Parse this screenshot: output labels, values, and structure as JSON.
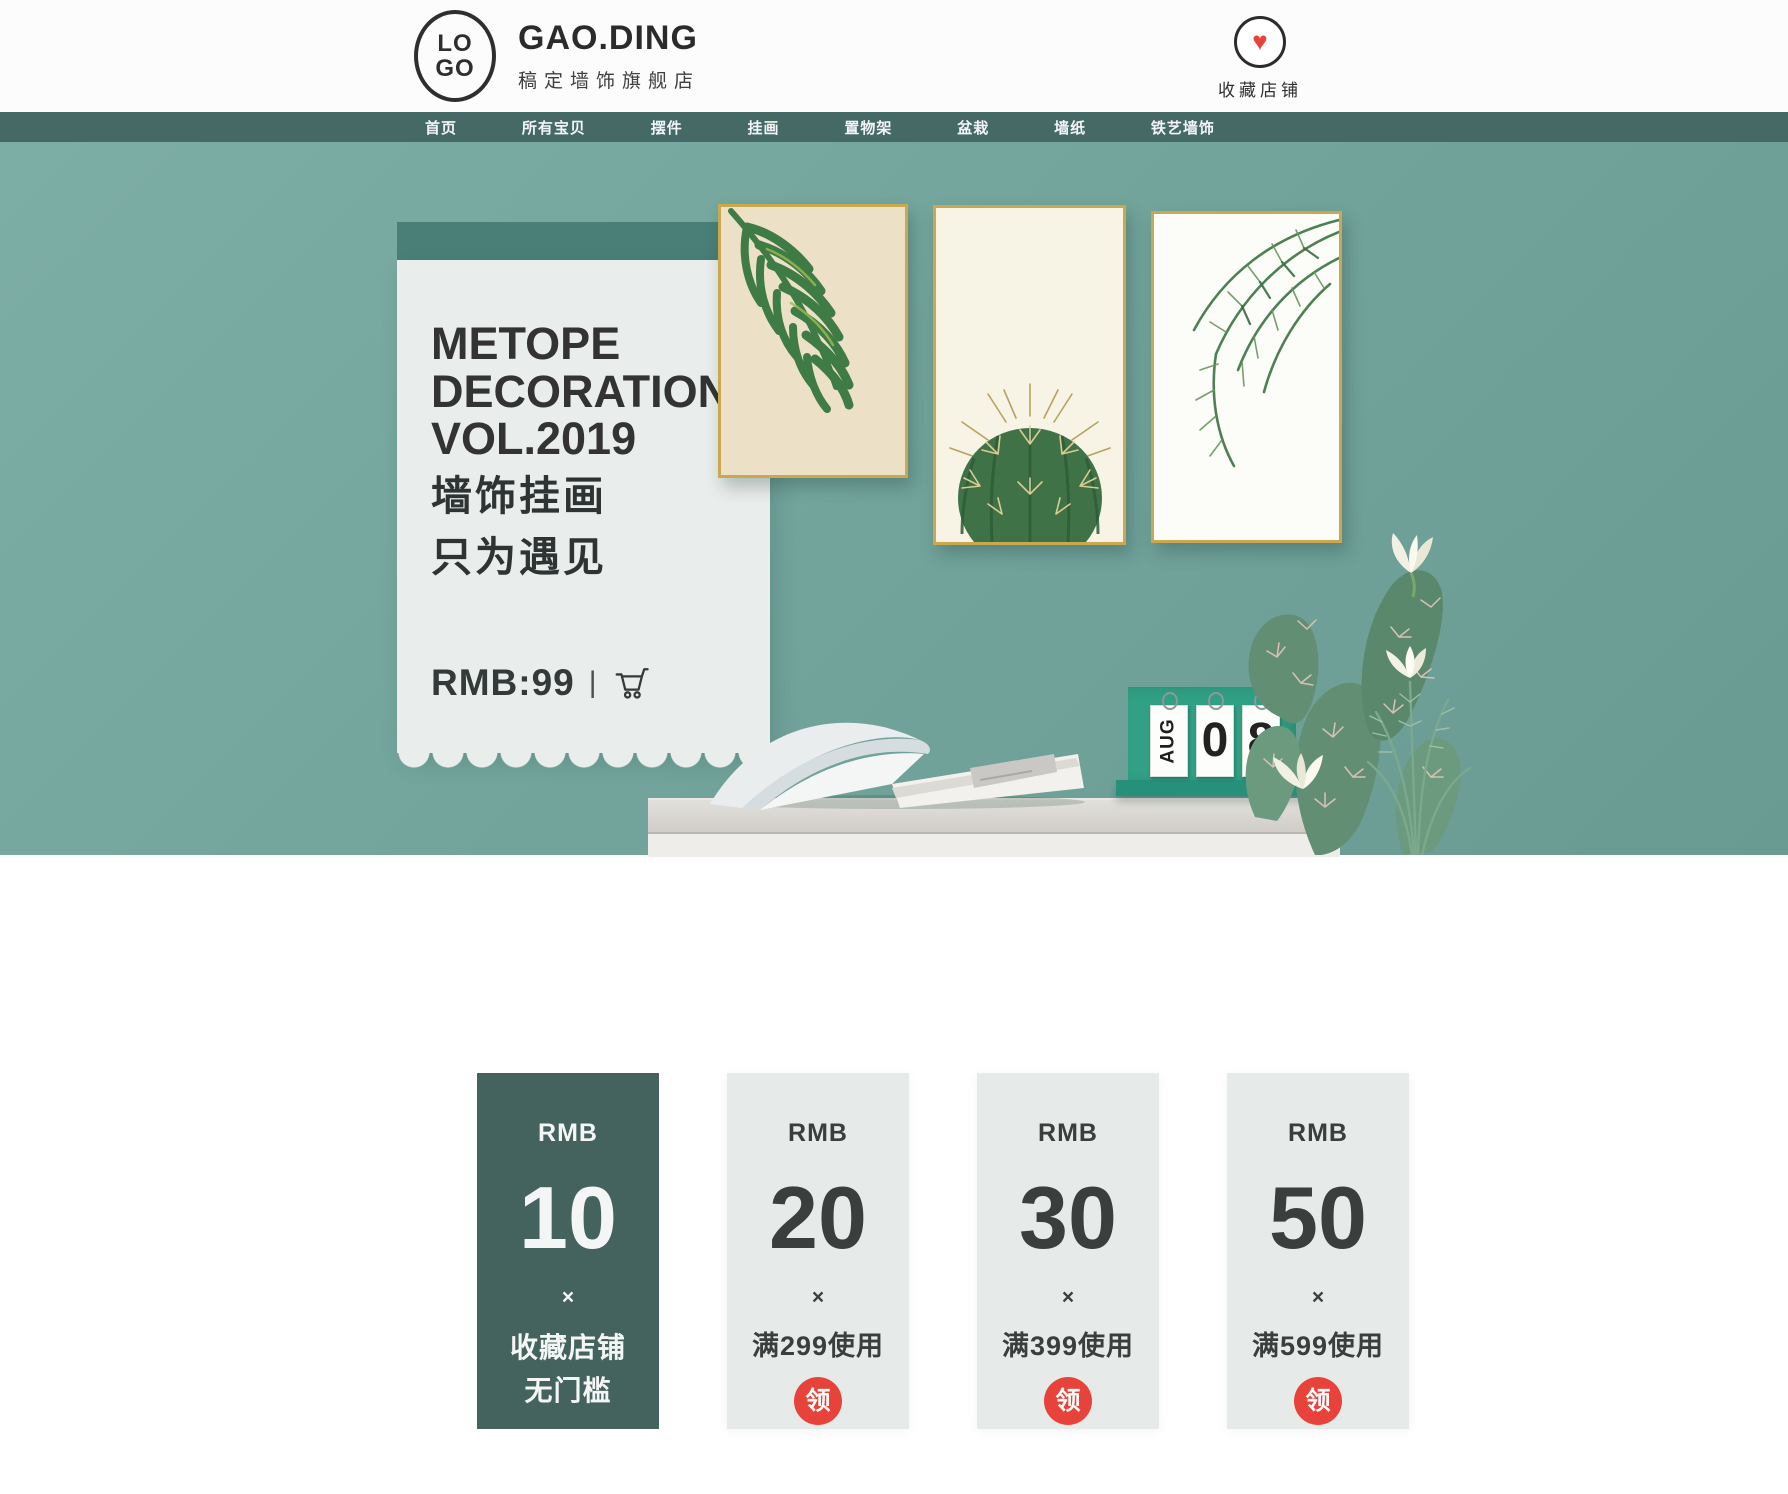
{
  "header": {
    "logo_top": "LO",
    "logo_bottom": "GO",
    "brand": "GAO.DING",
    "brand_sub": "稿定墙饰旗舰店",
    "favorite_label": "收藏店铺"
  },
  "icons": {
    "heart_glyph": "♥"
  },
  "nav": {
    "items": [
      {
        "label": "首页"
      },
      {
        "label": "所有宝贝"
      },
      {
        "label": "摆件"
      },
      {
        "label": "挂画"
      },
      {
        "label": "置物架"
      },
      {
        "label": "盆栽"
      },
      {
        "label": "墙纸"
      },
      {
        "label": "铁艺墙饰"
      }
    ]
  },
  "hero": {
    "card": {
      "title_line1": "METOPE",
      "title_line2": "DECORATION",
      "title_line3": "VOL.2019",
      "subtitle_line1": "墙饰挂画",
      "subtitle_line2": "只为遇见",
      "price": "RMB:99",
      "divider": "|"
    },
    "calendar": {
      "month": "AUG",
      "day_tens": "0",
      "day_ones": "8"
    }
  },
  "coupons": [
    {
      "currency": "RMB",
      "amount": "10",
      "separator": "×",
      "note_line1": "收藏店铺",
      "note_line2": "无门槛"
    },
    {
      "currency": "RMB",
      "amount": "20",
      "separator": "×",
      "condition": "满299使用",
      "badge": "领"
    },
    {
      "currency": "RMB",
      "amount": "30",
      "separator": "×",
      "condition": "满399使用",
      "badge": "领"
    },
    {
      "currency": "RMB",
      "amount": "50",
      "separator": "×",
      "condition": "满599使用",
      "badge": "领"
    }
  ],
  "colors": {
    "nav_teal": "#456a66",
    "wall_teal": "#73a59d",
    "card_header_teal": "#4a7f78",
    "card_bg": "#e9edeb",
    "coupon_dark": "#44625e",
    "coupon_light": "#e6eae8",
    "badge_red": "#e8433a",
    "heart_red": "#e8433a",
    "frame_gold": "#c9a84f",
    "calendar_green": "#31a085"
  }
}
